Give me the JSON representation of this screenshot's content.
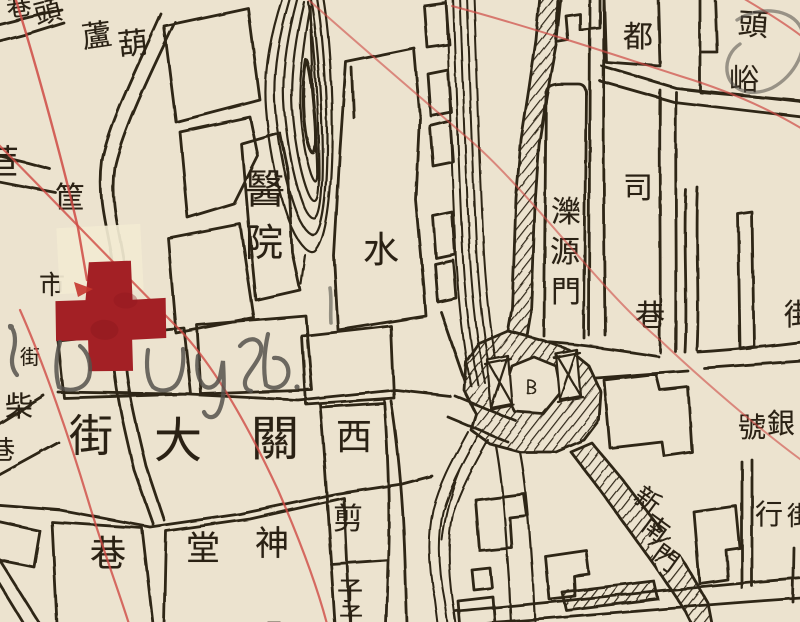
{
  "map": {
    "description": "hand-drawn historical city map sheet",
    "colors": {
      "paper": "#ece3cf",
      "paper_patch": "#f2ead2",
      "ink": "#2e2518",
      "route_red": "#cf4a44",
      "cross_red": "#a32025",
      "pencil_grey": "#55524c"
    },
    "annotations": {
      "red_cross_stamp": "hand-painted red cross marking a location",
      "pencil_note_transcription": "Ld UYb.",
      "pencil_circle": "pencil circle around top-right label"
    },
    "labels": [
      {
        "text": "巷",
        "x": 19,
        "y": 7,
        "size": 25,
        "rot": -8
      },
      {
        "text": "頭",
        "x": 48,
        "y": 13,
        "size": 27,
        "rot": -14
      },
      {
        "text": "蘆",
        "x": 97,
        "y": 37,
        "size": 30,
        "rot": -8
      },
      {
        "text": "葫",
        "x": 133,
        "y": 45,
        "size": 30,
        "rot": -6
      },
      {
        "text": "苣",
        "x": 2,
        "y": 163,
        "size": 34,
        "rot": 0
      },
      {
        "text": "筐",
        "x": 70,
        "y": 199,
        "size": 30,
        "rot": 0
      },
      {
        "text": "市",
        "x": 52,
        "y": 286,
        "size": 26,
        "rot": 0
      },
      {
        "text": "街",
        "x": 30,
        "y": 357,
        "size": 20,
        "rot": 0
      },
      {
        "text": "柴",
        "x": 19,
        "y": 407,
        "size": 28,
        "rot": 0
      },
      {
        "text": "巷",
        "x": 2,
        "y": 451,
        "size": 26,
        "rot": 0
      },
      {
        "text": "街",
        "x": 91,
        "y": 437,
        "size": 44,
        "rot": 0
      },
      {
        "text": "大",
        "x": 178,
        "y": 441,
        "size": 48,
        "rot": 0
      },
      {
        "text": "關",
        "x": 275,
        "y": 439,
        "size": 48,
        "rot": 0
      },
      {
        "text": "巷",
        "x": 108,
        "y": 555,
        "size": 36,
        "rot": 0
      },
      {
        "text": "堂",
        "x": 203,
        "y": 549,
        "size": 34,
        "rot": 0
      },
      {
        "text": "神",
        "x": 272,
        "y": 544,
        "size": 34,
        "rot": 0
      },
      {
        "text": "醫",
        "x": 265,
        "y": 190,
        "size": 40,
        "rot": 0
      },
      {
        "text": "院",
        "x": 264,
        "y": 243,
        "size": 38,
        "rot": 0
      },
      {
        "text": "水",
        "x": 381,
        "y": 251,
        "size": 36,
        "rot": 0
      },
      {
        "text": "西",
        "x": 354,
        "y": 438,
        "size": 36,
        "rot": 0
      },
      {
        "text": "剪",
        "x": 348,
        "y": 520,
        "size": 30,
        "rot": 0
      },
      {
        "text": "子",
        "x": 350,
        "y": 592,
        "size": 26,
        "rot": 0
      },
      {
        "text": "濼",
        "x": 566,
        "y": 213,
        "size": 30,
        "rot": 0
      },
      {
        "text": "源",
        "x": 565,
        "y": 253,
        "size": 30,
        "rot": 0
      },
      {
        "text": "門",
        "x": 566,
        "y": 293,
        "size": 30,
        "rot": 0
      },
      {
        "text": "都",
        "x": 638,
        "y": 38,
        "size": 30,
        "rot": 0
      },
      {
        "text": "司",
        "x": 638,
        "y": 189,
        "size": 30,
        "rot": 0
      },
      {
        "text": "巷",
        "x": 650,
        "y": 317,
        "size": 30,
        "rot": 0
      },
      {
        "text": "頭",
        "x": 753,
        "y": 26,
        "size": 30,
        "rot": 4
      },
      {
        "text": "峪",
        "x": 744,
        "y": 81,
        "size": 30,
        "rot": 0
      },
      {
        "text": "街",
        "x": 799,
        "y": 316,
        "size": 30,
        "rot": 0
      },
      {
        "text": "號",
        "x": 752,
        "y": 428,
        "size": 28,
        "rot": 0
      },
      {
        "text": "銀",
        "x": 781,
        "y": 424,
        "size": 28,
        "rot": 0
      },
      {
        "text": "行",
        "x": 769,
        "y": 515,
        "size": 28,
        "rot": 0
      },
      {
        "text": "街",
        "x": 800,
        "y": 517,
        "size": 26,
        "rot": 0
      },
      {
        "text": "新",
        "x": 647,
        "y": 501,
        "size": 26,
        "rot": 36
      },
      {
        "text": "南",
        "x": 655,
        "y": 529,
        "size": 26,
        "rot": 36
      },
      {
        "text": "門",
        "x": 665,
        "y": 559,
        "size": 26,
        "rot": 36
      },
      {
        "text": "子",
        "x": 351,
        "y": 616,
        "size": 24,
        "rot": 0
      }
    ]
  }
}
